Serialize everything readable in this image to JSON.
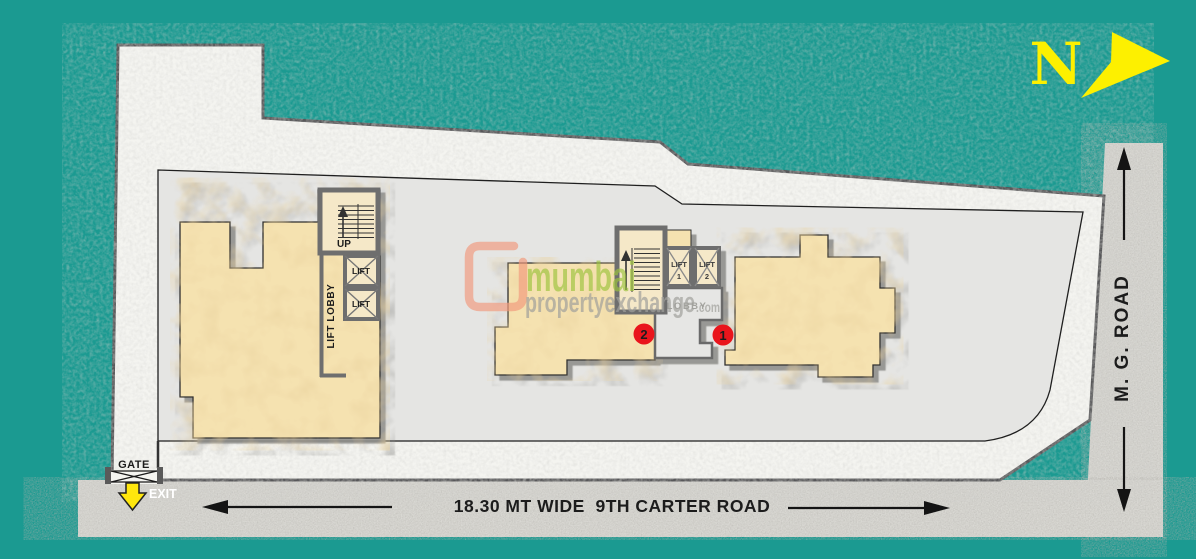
{
  "plan": {
    "north_label": "N",
    "roads": {
      "carter": {
        "label": "18.30 MT WIDE  9TH CARTER ROAD"
      },
      "mg": {
        "label": "M. G. ROAD"
      }
    },
    "gate": {
      "gate_label": "GATE",
      "exit_label": "EXIT"
    },
    "left_core": {
      "up_label": "UP",
      "lift_lobby_label": "LIFT LOBBY",
      "lifts": [
        "LIFT",
        "LIFT"
      ]
    },
    "center_core": {
      "lobby_label": "LOBBY",
      "lifts": [
        {
          "label": "LIFT",
          "number": "1"
        },
        {
          "label": "LIFT",
          "number": "2"
        }
      ]
    },
    "unit_markers": [
      {
        "number": "2"
      },
      {
        "number": "1"
      }
    ]
  },
  "watermark": {
    "brand": "mumbai",
    "brand_suffix": "propertyexchange",
    "tld": ".com"
  },
  "colors": {
    "teal_background": "#1b9a91",
    "road_gray": "#d9d8d3",
    "plot_white": "#f4f4f0",
    "compound_gray": "#e5e5e3",
    "building_tan": "#f5e2b0",
    "core_tan": "#f5e8c8",
    "wall_gray": "#6e6e6e",
    "marker_red": "#e9151c",
    "marker_number_yellow": "#ffd60a",
    "north_yellow": "#fdf000",
    "gate_cyan": "#35b7e9",
    "exit_arrow_yellow": "#ffe70d",
    "brand_green": "#9cc43e",
    "brand_gray": "#a0a09c",
    "brand_logo_orange": "#f2997b"
  }
}
